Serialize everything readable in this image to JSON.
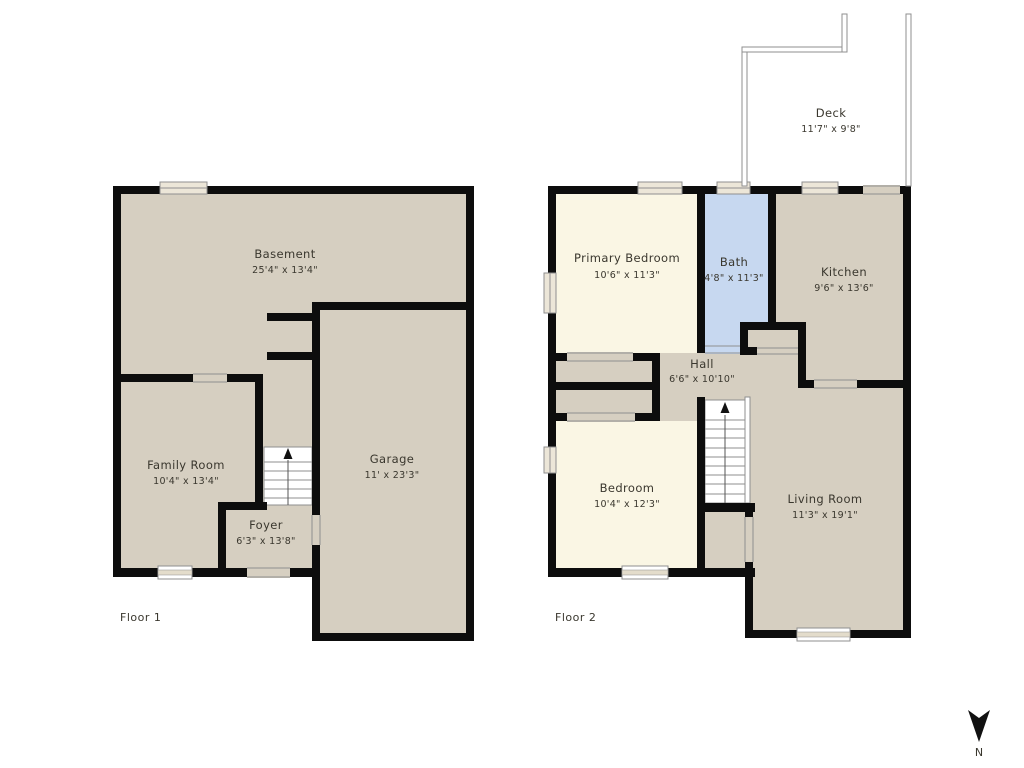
{
  "floor1": {
    "label": "Floor 1",
    "rooms": {
      "basement": {
        "name": "Basement",
        "dims": "25'4\" x 13'4\""
      },
      "family_room": {
        "name": "Family Room",
        "dims": "10'4\" x 13'4\""
      },
      "foyer": {
        "name": "Foyer",
        "dims": "6'3\" x 13'8\""
      },
      "garage": {
        "name": "Garage",
        "dims": "11' x 23'3\""
      }
    }
  },
  "floor2": {
    "label": "Floor 2",
    "rooms": {
      "primary_bedroom": {
        "name": "Primary Bedroom",
        "dims": "10'6\" x 11'3\""
      },
      "bath": {
        "name": "Bath",
        "dims": "4'8\" x 11'3\""
      },
      "kitchen": {
        "name": "Kitchen",
        "dims": "9'6\" x 13'6\""
      },
      "hall": {
        "name": "Hall",
        "dims": "6'6\" x 10'10\""
      },
      "bedroom": {
        "name": "Bedroom",
        "dims": "10'4\" x 12'3\""
      },
      "living_room": {
        "name": "Living Room",
        "dims": "11'3\" x 19'1\""
      },
      "deck": {
        "name": "Deck",
        "dims": "11'7\" x 9'8\""
      }
    }
  },
  "compass": {
    "label": "N"
  },
  "colors": {
    "wall": "#0d0d0d",
    "room_tan": "#d6cfc1",
    "room_cream": "#faf6e4",
    "room_bath_blue": "#c7d8f0",
    "opening_outline": "#8f8f8f",
    "window_fill": "#ece6d8",
    "text": "#3a372e"
  }
}
